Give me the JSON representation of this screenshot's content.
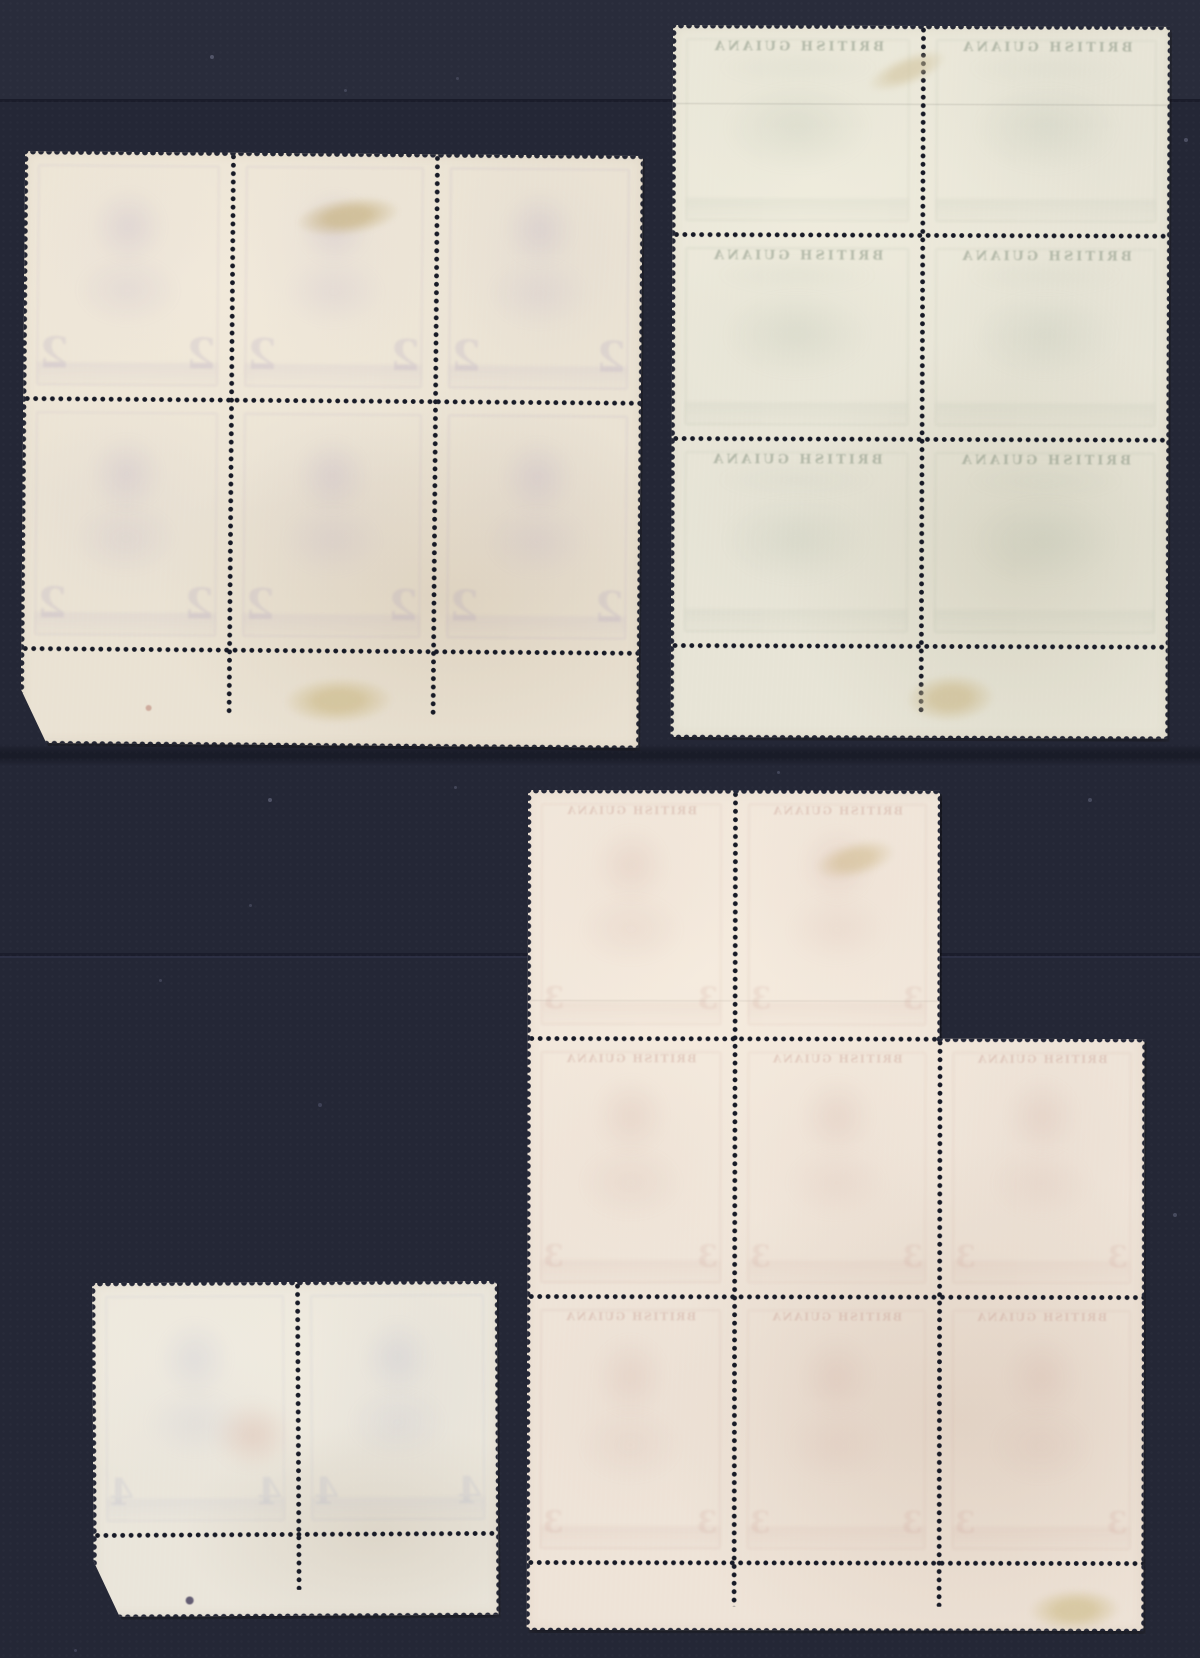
{
  "meta": {
    "title": "Four mint stamp multiples shown gum-side (reverse) with perforations, selvage margins and hinge remnants on a dark navy stockbook page"
  },
  "canvas": {
    "width": 1200,
    "height": 1658,
    "background": "#242736"
  },
  "page": {
    "bands": [
      {
        "y": 0,
        "h": 99,
        "color": "#292c3b"
      }
    ],
    "seams": [
      {
        "y": 99,
        "h": 3,
        "color": "#1a1c29",
        "opacity": 0.9
      },
      {
        "y": 744,
        "h": 22,
        "color": "#10121c",
        "opacity": 0.55,
        "soft": true
      },
      {
        "y": 953,
        "h": 3,
        "color": "#1b1d2b",
        "opacity": 0.9
      },
      {
        "y": 956,
        "h": 2,
        "color": "#303349",
        "opacity": 0.7
      }
    ],
    "specks": [
      {
        "x": 212,
        "y": 57,
        "r": 2,
        "color": "#565a6e",
        "opacity": 0.9
      },
      {
        "x": 345,
        "y": 90,
        "r": 1.5,
        "color": "#4b4f63",
        "opacity": 0.8
      },
      {
        "x": 457,
        "y": 78,
        "r": 1.5,
        "color": "#4b4f63",
        "opacity": 0.7
      },
      {
        "x": 1008,
        "y": 57,
        "r": 1.5,
        "color": "#50546a",
        "opacity": 0.7
      },
      {
        "x": 1186,
        "y": 140,
        "r": 2,
        "color": "#565a6e",
        "opacity": 0.8
      },
      {
        "x": 270,
        "y": 800,
        "r": 2,
        "color": "#5a5e72",
        "opacity": 0.8
      },
      {
        "x": 455,
        "y": 787,
        "r": 1.5,
        "color": "#4b4f63",
        "opacity": 0.8
      },
      {
        "x": 778,
        "y": 772,
        "r": 1.5,
        "color": "#50546a",
        "opacity": 0.7
      },
      {
        "x": 1090,
        "y": 800,
        "r": 2,
        "color": "#565a6e",
        "opacity": 0.7
      },
      {
        "x": 160,
        "y": 980,
        "r": 1.5,
        "color": "#4b4f63",
        "opacity": 0.7
      },
      {
        "x": 320,
        "y": 1105,
        "r": 2,
        "color": "#50546a",
        "opacity": 0.6
      },
      {
        "x": 250,
        "y": 905,
        "r": 1.5,
        "color": "#4b4f63",
        "opacity": 0.7
      },
      {
        "x": 1175,
        "y": 1215,
        "r": 2,
        "color": "#565a6e",
        "opacity": 0.7
      },
      {
        "x": 75,
        "y": 1650,
        "r": 1.5,
        "color": "#50546a",
        "opacity": 0.6
      }
    ]
  },
  "perf": {
    "pitch": 8.4,
    "holeRadius": 2.1,
    "toothRadius": 2.6,
    "holeColor": "#171a26"
  },
  "blocks": [
    {
      "id": "block-top-left-six",
      "label": "Block of six (3 x 2), portrait stamps, bottom selvage, gum side",
      "x": 25,
      "y": 151,
      "w": 618,
      "h": 592,
      "rotate": 0.45,
      "polygon": [
        [
          0,
          0
        ],
        [
          618,
          0
        ],
        [
          618,
          592
        ],
        [
          26,
          592
        ],
        [
          0,
          538
        ]
      ],
      "paper": "#eae2d3",
      "paperHi": "#f2eadb",
      "paperLo": "#ded3c1",
      "toothColor": "#232634",
      "stamps": [
        {
          "x": 0,
          "y": 0,
          "w": 208,
          "h": 247
        },
        {
          "x": 208,
          "y": 0,
          "w": 204,
          "h": 247
        },
        {
          "x": 412,
          "y": 0,
          "w": 206,
          "h": 247
        },
        {
          "x": 0,
          "y": 247,
          "w": 208,
          "h": 250
        },
        {
          "x": 208,
          "y": 247,
          "w": 204,
          "h": 250
        },
        {
          "x": 412,
          "y": 247,
          "w": 206,
          "h": 250
        }
      ],
      "vlines": [
        {
          "x": 208,
          "y1": 0,
          "y2": 563
        },
        {
          "x": 412,
          "y1": 0,
          "y2": 563
        }
      ],
      "hlines": [
        {
          "y": 247,
          "x1": 0,
          "x2": 618
        },
        {
          "y": 497,
          "x1": 0,
          "x2": 618
        }
      ],
      "edges": [
        {
          "side": "top",
          "y": 0,
          "x1": 0,
          "x2": 618
        },
        {
          "side": "right",
          "x": 618,
          "y1": 0,
          "y2": 592
        },
        {
          "side": "bottom",
          "y": 592,
          "x1": 26,
          "x2": 618
        },
        {
          "side": "left",
          "x": 0,
          "y1": 0,
          "y2": 538
        }
      ],
      "show": {
        "tint": "#b0a0c2",
        "blob": "portrait",
        "digit": "2",
        "digitColor": "#9d8fb8",
        "digitSize": 42,
        "digitOpacity": 0.17,
        "arcText": null,
        "textColor": null,
        "textOpacity": 0
      },
      "hinges": [
        {
          "x": 271,
          "y": 44,
          "w": 105,
          "h": 38,
          "rot": -8,
          "color": "#ccb98e",
          "opacity": 0.8
        },
        {
          "x": 263,
          "y": 524,
          "w": 110,
          "h": 46,
          "rot": -2,
          "color": "#d2c298",
          "opacity": 0.85
        }
      ],
      "marks": [
        {
          "type": "speck",
          "x": 128,
          "y": 556,
          "r": 3,
          "color": "#b4776a",
          "opacity": 0.5
        }
      ],
      "creases": []
    },
    {
      "id": "block-top-right-six",
      "label": "Block of six (2 x 3), landscape British Guiana stamps, bottom selvage, gum side",
      "x": 673,
      "y": 25,
      "w": 497,
      "h": 712,
      "rotate": 0.2,
      "polygon": [
        [
          0,
          0
        ],
        [
          497,
          0
        ],
        [
          497,
          712
        ],
        [
          0,
          712
        ]
      ],
      "paper": "#e7e4d6",
      "paperHi": "#efecdd",
      "paperLo": "#d9d6c5",
      "toothColor": "#242736",
      "stamps": [
        {
          "x": 0,
          "y": 0,
          "w": 250,
          "h": 209
        },
        {
          "x": 250,
          "y": 0,
          "w": 247,
          "h": 209
        },
        {
          "x": 0,
          "y": 209,
          "w": 250,
          "h": 204
        },
        {
          "x": 250,
          "y": 209,
          "w": 247,
          "h": 204
        },
        {
          "x": 0,
          "y": 413,
          "w": 250,
          "h": 207
        },
        {
          "x": 250,
          "y": 413,
          "w": 247,
          "h": 207
        }
      ],
      "vlines": [
        {
          "x": 250,
          "y1": 0,
          "y2": 688
        }
      ],
      "hlines": [
        {
          "y": 209,
          "x1": 0,
          "x2": 497
        },
        {
          "y": 413,
          "x1": 0,
          "x2": 497
        },
        {
          "y": 620,
          "x1": 0,
          "x2": 497
        }
      ],
      "edges": [
        {
          "side": "top",
          "y": 0,
          "x1": 0,
          "x2": 497
        },
        {
          "side": "right",
          "x": 497,
          "y1": 0,
          "y2": 712
        },
        {
          "side": "bottom",
          "y": 712,
          "x1": 0,
          "x2": 497
        },
        {
          "side": "left",
          "x": 0,
          "y1": 0,
          "y2": 712
        }
      ],
      "show": {
        "tint": "#a9b4a4",
        "blob": "landscape",
        "digit": null,
        "digitColor": null,
        "digitSize": 0,
        "digitOpacity": 0,
        "arcText": "BRITISH GUIANA",
        "textColor": "#7f8d7b",
        "textOpacity": 0.5
      },
      "hinges": [
        {
          "x": 192,
          "y": 30,
          "w": 85,
          "h": 30,
          "rot": -22,
          "color": "#cfc098",
          "opacity": 0.55
        },
        {
          "x": 235,
          "y": 648,
          "w": 90,
          "h": 48,
          "rot": -3,
          "color": "#d0c199",
          "opacity": 0.8
        }
      ],
      "marks": [],
      "creases": [
        {
          "x1": 0,
          "y": 78,
          "x2": 497,
          "color": "rgba(100,100,95,0.22)"
        }
      ]
    },
    {
      "id": "block-bottom-right-eight",
      "label": "Irregular block of eight, portrait stamps, bottom selvage, gum side",
      "x": 528,
      "y": 790,
      "w": 617,
      "h": 840,
      "rotate": 0.1,
      "polygon": [
        [
          0,
          0
        ],
        [
          412,
          0
        ],
        [
          412,
          248
        ],
        [
          617,
          248
        ],
        [
          617,
          840
        ],
        [
          0,
          840
        ]
      ],
      "paper": "#eee3d7",
      "paperHi": "#f5ebde",
      "paperLo": "#e2d3c5",
      "toothColor": "#242737",
      "stamps": [
        {
          "x": 0,
          "y": 0,
          "w": 207,
          "h": 248
        },
        {
          "x": 207,
          "y": 0,
          "w": 205,
          "h": 248
        },
        {
          "x": 0,
          "y": 248,
          "w": 207,
          "h": 258
        },
        {
          "x": 207,
          "y": 248,
          "w": 205,
          "h": 258
        },
        {
          "x": 412,
          "y": 248,
          "w": 205,
          "h": 258
        },
        {
          "x": 0,
          "y": 506,
          "w": 207,
          "h": 266
        },
        {
          "x": 207,
          "y": 506,
          "w": 205,
          "h": 266
        },
        {
          "x": 412,
          "y": 506,
          "w": 205,
          "h": 266
        }
      ],
      "vlines": [
        {
          "x": 207,
          "y1": 0,
          "y2": 816
        },
        {
          "x": 412,
          "y1": 248,
          "y2": 816
        }
      ],
      "hlines": [
        {
          "y": 248,
          "x1": 0,
          "x2": 412
        },
        {
          "y": 506,
          "x1": 0,
          "x2": 617
        },
        {
          "y": 772,
          "x1": 0,
          "x2": 617
        }
      ],
      "edges": [
        {
          "side": "top",
          "y": 0,
          "x1": 0,
          "x2": 412
        },
        {
          "side": "right",
          "x": 412,
          "y1": 0,
          "y2": 248
        },
        {
          "side": "top",
          "y": 248,
          "x1": 412,
          "x2": 617
        },
        {
          "side": "right",
          "x": 617,
          "y1": 248,
          "y2": 840
        },
        {
          "side": "bottom",
          "y": 840,
          "x1": 0,
          "x2": 617
        },
        {
          "side": "left",
          "x": 0,
          "y1": 0,
          "y2": 840
        }
      ],
      "show": {
        "tint": "#cda89e",
        "blob": "portrait",
        "digit": "3",
        "digitColor": "#c59288",
        "digitSize": 30,
        "digitOpacity": 0.14,
        "arcText": "BRITISH GUIANA",
        "textColor": "#c09086",
        "textOpacity": 0.32
      },
      "hinges": [
        {
          "x": 286,
          "y": 51,
          "w": 82,
          "h": 36,
          "rot": -14,
          "color": "#d2bd92",
          "opacity": 0.6
        },
        {
          "x": 502,
          "y": 798,
          "w": 92,
          "h": 42,
          "rot": -2,
          "color": "#d5c59c",
          "opacity": 0.85
        }
      ],
      "marks": [],
      "creases": [
        {
          "x1": 0,
          "y": 210,
          "x2": 412,
          "color": "rgba(110,95,90,0.15)"
        }
      ]
    },
    {
      "id": "pair-bottom-left",
      "label": "Horizontal pair, portrait stamps, bottom selvage, gum side",
      "x": 92,
      "y": 1283,
      "w": 405,
      "h": 334,
      "rotate": -0.3,
      "polygon": [
        [
          0,
          0
        ],
        [
          405,
          0
        ],
        [
          405,
          334
        ],
        [
          26,
          334
        ],
        [
          0,
          278
        ]
      ],
      "paper": "#eae5da",
      "paperHi": "#f2ede1",
      "paperLo": "#ddd6c9",
      "toothColor": "#242737",
      "stamps": [
        {
          "x": 0,
          "y": 0,
          "w": 205,
          "h": 252
        },
        {
          "x": 205,
          "y": 0,
          "w": 200,
          "h": 252
        }
      ],
      "vlines": [
        {
          "x": 205,
          "y1": 0,
          "y2": 308
        }
      ],
      "hlines": [
        {
          "y": 252,
          "x1": 0,
          "x2": 405
        }
      ],
      "edges": [
        {
          "side": "top",
          "y": 0,
          "x1": 0,
          "x2": 405
        },
        {
          "side": "right",
          "x": 405,
          "y1": 0,
          "y2": 334
        },
        {
          "side": "bottom",
          "y": 334,
          "x1": 26,
          "x2": 405
        },
        {
          "side": "left",
          "x": 0,
          "y1": 0,
          "y2": 278
        }
      ],
      "show": {
        "tint": "#aeb0ca",
        "blob": "portrait",
        "digit": "4",
        "digitColor": "#989fc2",
        "digitSize": 36,
        "digitOpacity": 0.15,
        "arcText": null,
        "textColor": null,
        "textOpacity": 0
      },
      "hinges": [],
      "marks": [
        {
          "type": "blob",
          "x": 120,
          "y": 118,
          "w": 80,
          "h": 70,
          "color": "#c4816f",
          "opacity": 0.22
        },
        {
          "type": "speck",
          "x": 96,
          "y": 318,
          "r": 4,
          "color": "#554f68",
          "opacity": 0.9
        }
      ],
      "creases": []
    }
  ]
}
